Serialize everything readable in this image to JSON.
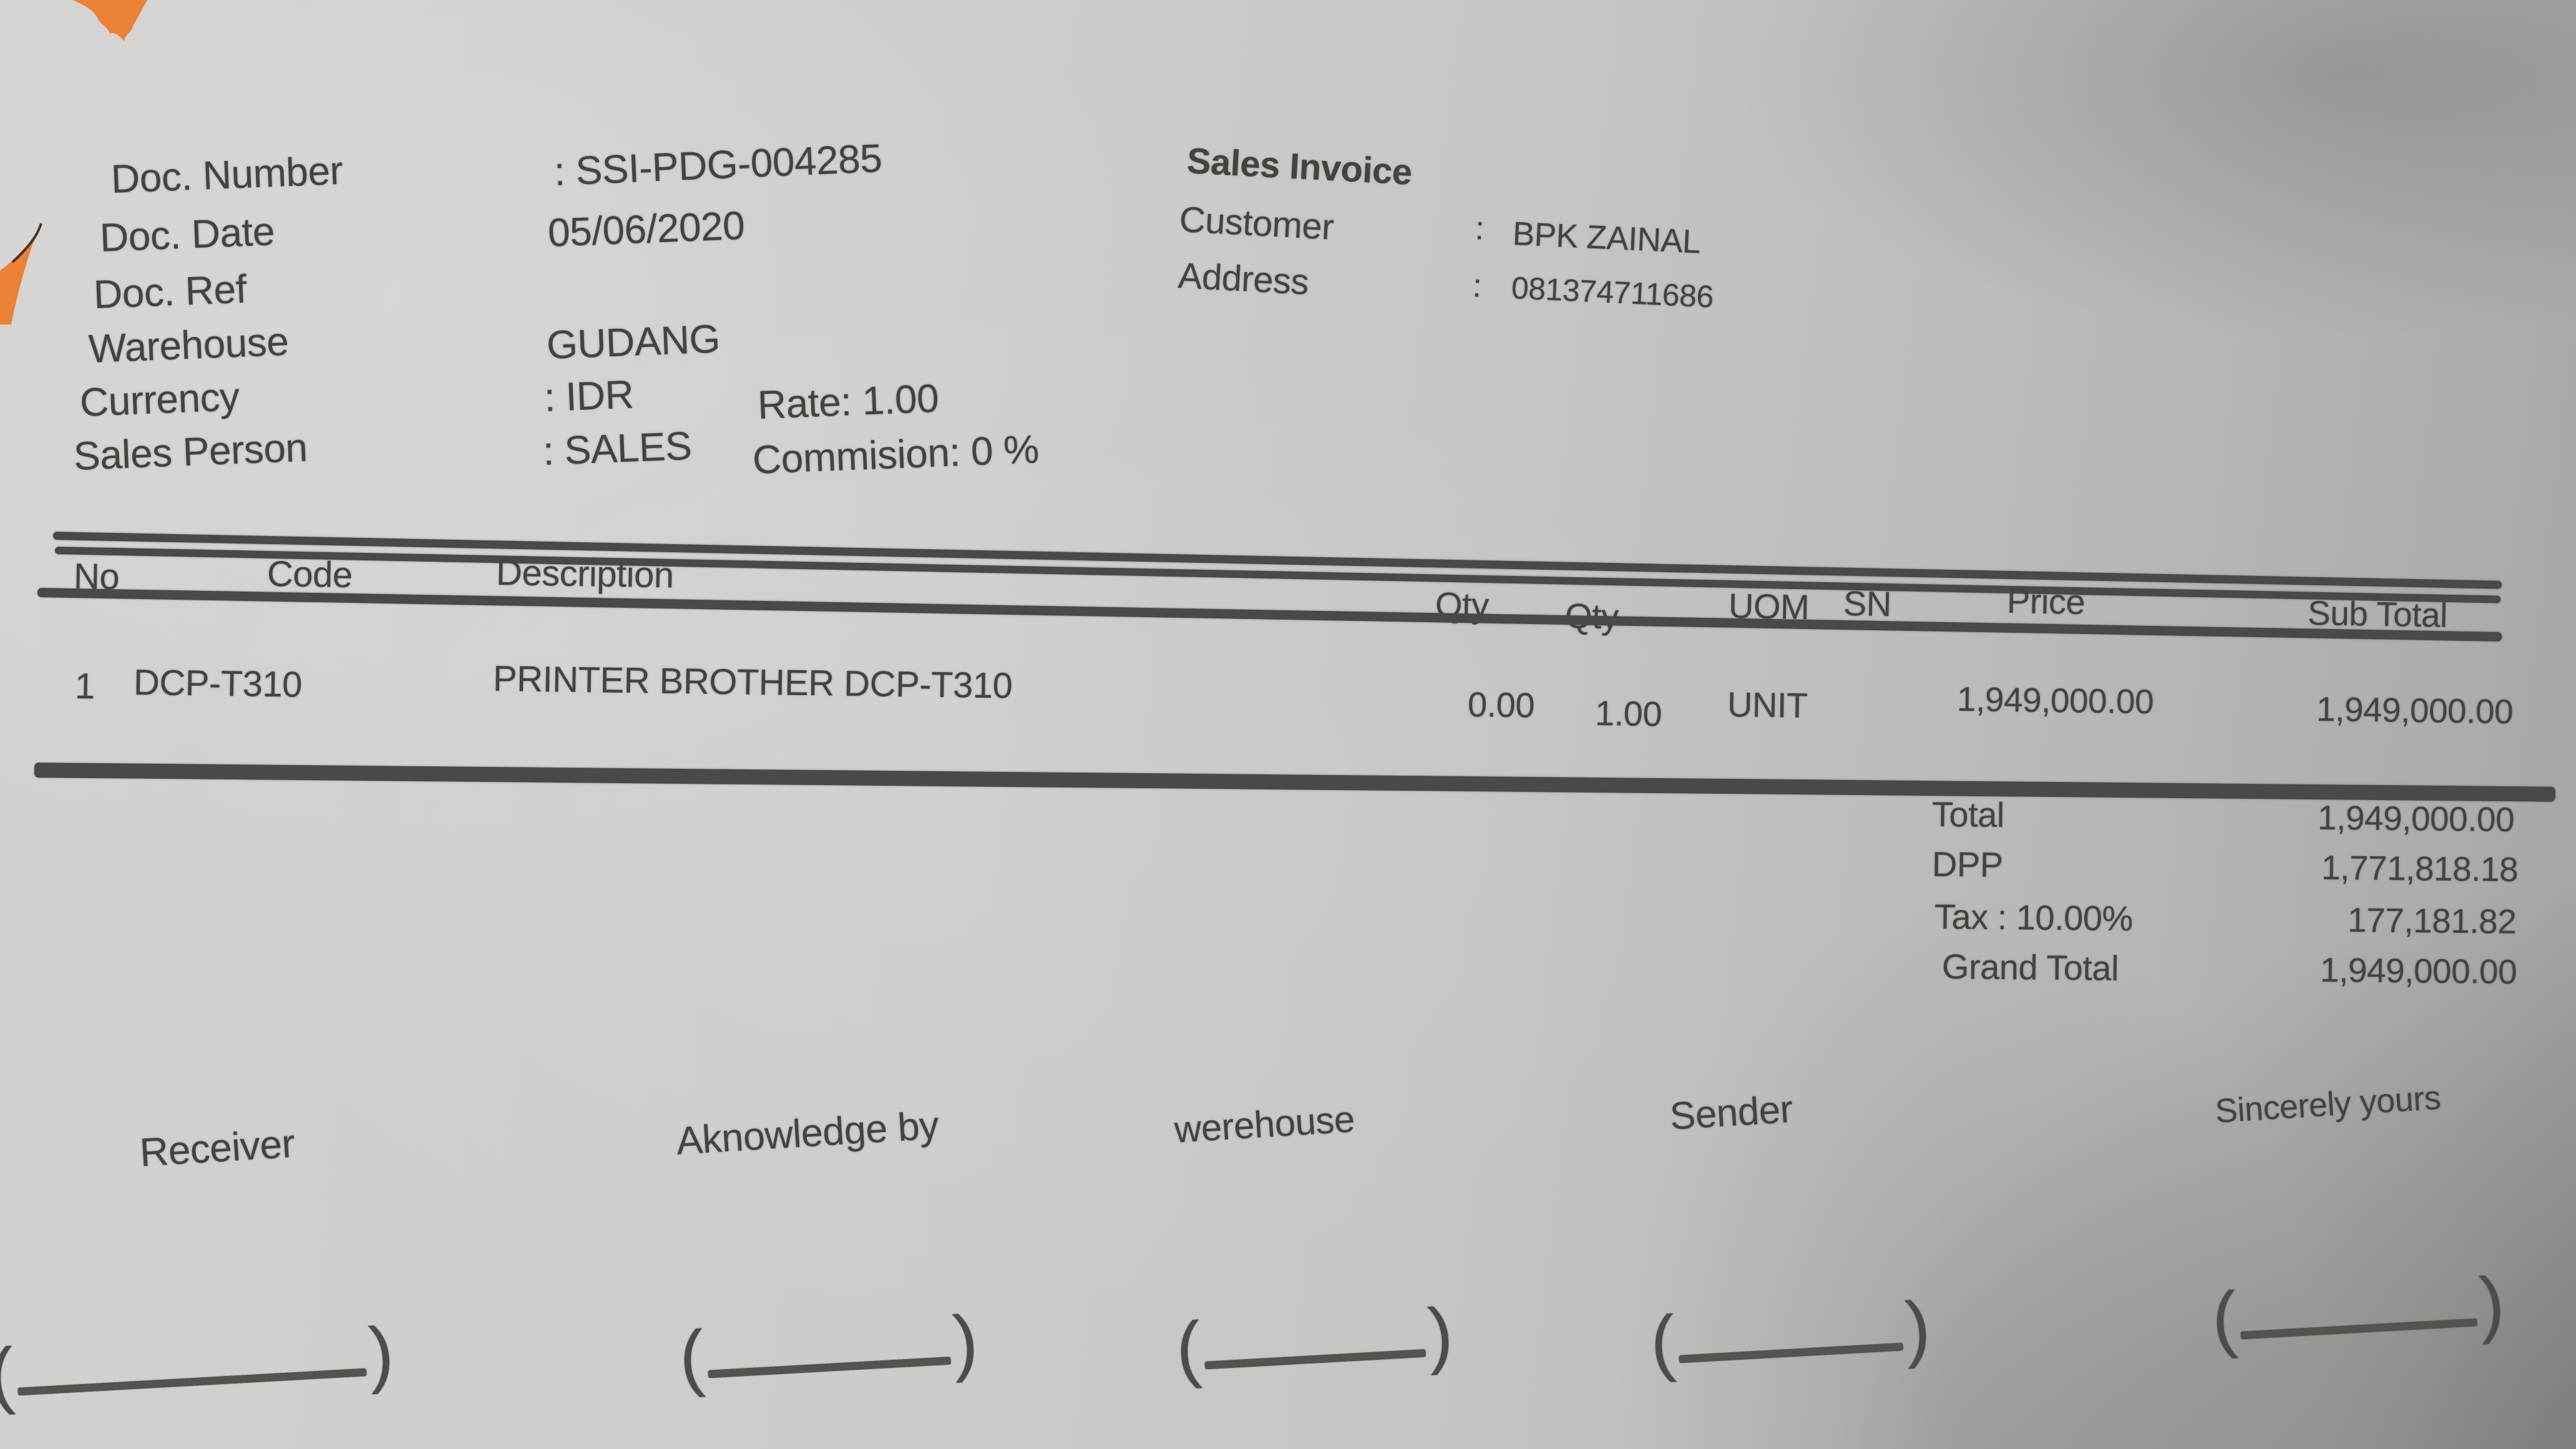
{
  "colors": {
    "paper": "#c9c8c6",
    "ink": "#45433e",
    "accent_orange": "#ec8138",
    "rule": "#4b4945"
  },
  "doc_info": {
    "rows": [
      {
        "label": "Doc. Number",
        "value": ": SSI-PDG-004285",
        "extra": ""
      },
      {
        "label": "Doc. Date",
        "value": "05/06/2020",
        "extra": ""
      },
      {
        "label": "Doc. Ref",
        "value": "",
        "extra": ""
      },
      {
        "label": "Warehouse",
        "value": "GUDANG",
        "extra": ""
      },
      {
        "label": "Currency",
        "value": ": IDR",
        "extra": "Rate: 1.00"
      },
      {
        "label": "Sales Person",
        "value": ": SALES",
        "extra": "Commision: 0 %"
      }
    ]
  },
  "invoice_header": {
    "title": "Sales Invoice",
    "customer_label": "Customer",
    "customer_colon": ":",
    "customer_value": "BPK ZAINAL",
    "address_label": "Address",
    "address_colon": ":",
    "address_value": "081374711686"
  },
  "items_table": {
    "headers": {
      "no": "No",
      "code": "Code",
      "description": "Description",
      "qty1": "Qty",
      "qty2": "Qty",
      "uom": "UOM",
      "sn": "SN",
      "price": "Price",
      "sub_total": "Sub Total"
    },
    "rows": [
      {
        "no": "1",
        "code": "DCP-T310",
        "description": "PRINTER BROTHER DCP-T310",
        "qty1": "0.00",
        "qty2": "1.00",
        "uom": "UNIT",
        "sn": "",
        "price": "1,949,000.00",
        "sub_total": "1,949,000.00"
      }
    ]
  },
  "totals": {
    "rows": [
      {
        "label": "Total",
        "value": "1,949,000.00"
      },
      {
        "label": "DPP",
        "value": "1,771,818.18"
      },
      {
        "label": "Tax : 10.00%",
        "value": "177,181.82"
      },
      {
        "label": "Grand Total",
        "value": "1,949,000.00"
      }
    ]
  },
  "signatures": {
    "labels": [
      "Receiver",
      "Aknowledge by",
      "werehouse",
      "Sender",
      "Sincerely yours"
    ]
  },
  "decor": {
    "stray_mark": ")",
    "paren_open": "(",
    "paren_close": ")"
  }
}
